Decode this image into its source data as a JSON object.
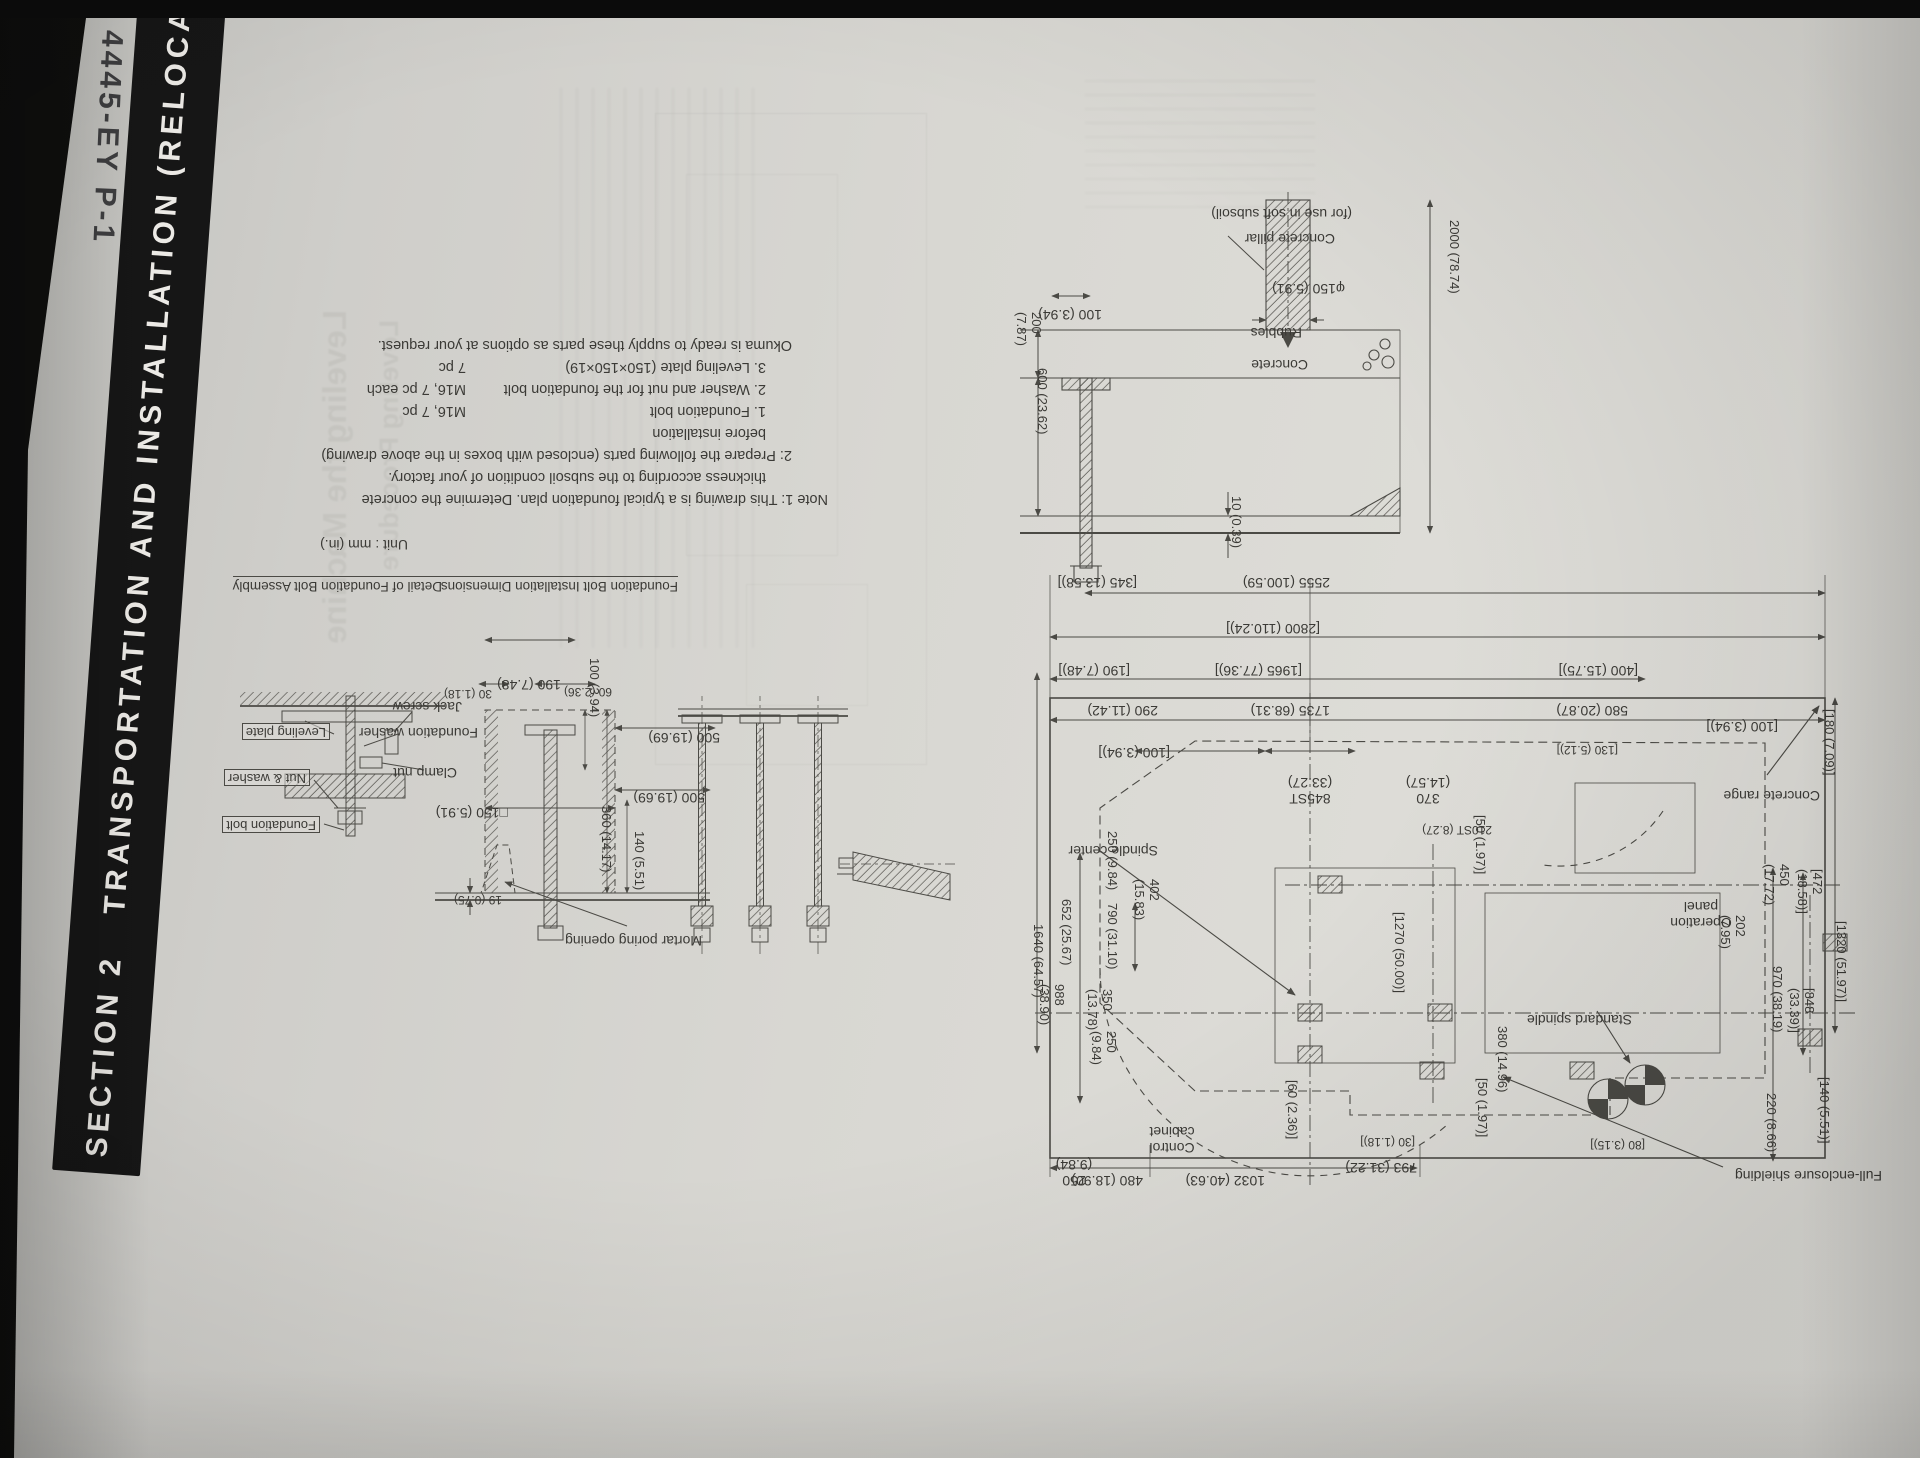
{
  "colors": {
    "paper": "#d6d5d0",
    "ink": "#3b3a36",
    "line": "#4b4a45",
    "band_bg": "#161616",
    "band_text": "#eceae6"
  },
  "band": {
    "text": "SECTION 2   TRANSPORTATION AND INSTALLATION (RELOCATION"
  },
  "page_code": {
    "text": "4445-EY P-1"
  },
  "heading": {
    "number": "5.",
    "title": "Foundation Plan"
  },
  "figure": {
    "unit_note": "Unit : mm (in.)",
    "notes": {
      "note1_l1": "Note 1: This drawing is a typical foundation plan. Determine the concrete",
      "note1_l2": "thickness according to the subsoil condition of your factory.",
      "note2_l1": "2: Prepare the following parts (enclosed with boxes in the above drawing)",
      "note2_l2": "before installation",
      "parts": [
        {
          "name": "1. Foundation bolt",
          "qty": "M16, 7 pc"
        },
        {
          "name": "2. Washer and nut for the foundation bolt",
          "qty": "M16, 7 pc each"
        },
        {
          "name": "3. Leveling plate (150×150×19)",
          "qty": "7 pc"
        }
      ],
      "closing": "Okuma is ready to supply these parts as options at your request."
    },
    "plan": {
      "labels": {
        "spindle_center": "Spindle center",
        "concrete_range": "Concrete range",
        "control_cabinet": "Control cabinet",
        "operation_panel": "Operation panel",
        "standard_spindle": "Standard spindle",
        "full_enclosure": "Full-enclosure shielding"
      },
      "dims": {
        "d2555": "2555 (100.59)",
        "d2800": "[2800 (110.24)]",
        "d1965": "[1965 (77.36)]",
        "d1735": "1735 (68.31)",
        "d345": "[345 (13.58)]",
        "d190": "[190 (7.48)]",
        "d290": "290 (11.42)",
        "d100a": "[100 (3.94)]",
        "d100b": "[100 (3.94)]",
        "d845st": "845ST (33.27)",
        "d370": "370 (14.57)",
        "d210st": "210ST (8.27)",
        "d400": "[400 (15.75)]",
        "d580": "580 (20.87)",
        "d130": "[130 (5.12)]",
        "d180": "[180 (7.09)]",
        "d450": "450 (17.72)",
        "d472": "[472 (18.58)]",
        "d1320": "[1320 (51.97)]",
        "d202": "202 (7.95)",
        "d970": "970 (38.19)",
        "d848": "[848 (33.39)]",
        "d140": "[140 (5.51)]",
        "d220": "220 (8.66)",
        "d480": "480 (18.90)",
        "d1032": "1032 (40.63)",
        "d793": "793 (31.22)",
        "d250a": "250 (9.84)",
        "d80": "[80 (3.15)]",
        "d60": "[60 (2.36)]",
        "d30": "[30 (1.18)]",
        "d380": "380 (14.96)",
        "d50a": "[50 (1.97)]",
        "d50b": "[50 (1.97)]",
        "d1270": "[1270 (50.00)]",
        "d250b": "250 (9.84)",
        "d652": "652 (25.67)",
        "d402": "402 (15.83)",
        "d790": "790 (31.10)",
        "d1640": "1640 (64.57)",
        "d988": "988 (38.90)",
        "d350": "350 (13.78)",
        "d250c": "250 (9.84)"
      }
    },
    "cross_section": {
      "labels": {
        "concrete_pillar": "Concrete pillar",
        "soft_subsoil": "(for use in soft subsoil)",
        "rubbles": "Rubbles",
        "concrete": "Concrete"
      },
      "dims": {
        "dia150": "φ150 (5.91)",
        "d100": "100 (3.94)",
        "d200": "200 (7.87)",
        "d600": "600 (23.62)",
        "d10": "10 (0.39)",
        "d2000": "2000 (78.74)"
      }
    },
    "bolt_install": {
      "title": "Foundation Bolt Installation Dimensions",
      "label_mortar": "Mortar poring opening",
      "dims": {
        "d190": "190 (7.48)",
        "d100": "100 (3.94)",
        "d60": "60 (2.36)",
        "d30": "30 (1.18)",
        "d150": "□150 (5.91)",
        "d19": "19 (0.75)",
        "d500a": "500 (19.69)",
        "d500b": "500 (19.69)",
        "d360": "360 (14.17)",
        "d140": "140 (5.51)"
      }
    },
    "bolt_assembly": {
      "title": "Detail of Foundation Bolt Assembly",
      "labels": {
        "leveling_plate": "Leveling plate",
        "nut_washer": "Nut & washer",
        "foundation_bolt": "Foundation bolt",
        "clamp_nut": "Clamp nut",
        "foundation_washer": "Foundation washer",
        "jack_screw": "Jack screw"
      }
    }
  },
  "bleed_through": {
    "ghost1": "Leveling the Machine",
    "ghost2": "Leveling Procedure"
  }
}
